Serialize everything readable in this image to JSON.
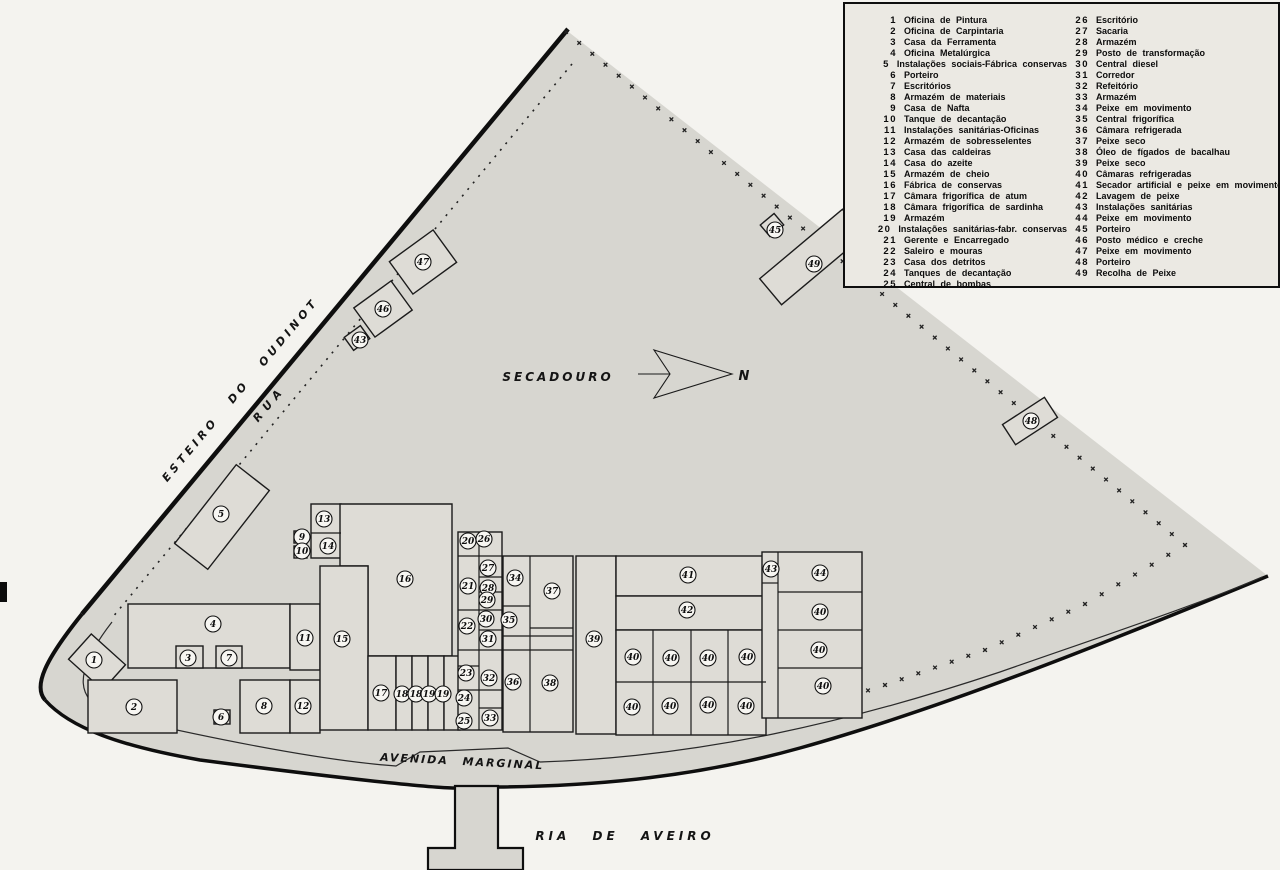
{
  "colors": {
    "paper": "#f4f3ef",
    "site_fill": "#d7d6d0",
    "building_fill": "#dedcd6",
    "ink": "#0e0e0e",
    "legend_bg": "#ebe9e3"
  },
  "map_labels": {
    "secadouro": "SECADOURO",
    "esteiro": "ESTEIRO DO OUDINOT",
    "rua": "RUA",
    "avenida": "AVENIDA MARGINAL",
    "ria": "RIA DE AVEIRO",
    "north": "N"
  },
  "legend": {
    "columns": [
      {
        "items": [
          {
            "num": "1",
            "label": "Oficina de Pintura"
          },
          {
            "num": "2",
            "label": "Oficina de Carpintaria"
          },
          {
            "num": "3",
            "label": "Casa da Ferramenta"
          },
          {
            "num": "4",
            "label": "Oficina Metalúrgica"
          },
          {
            "num": "5",
            "label": "Instalações sociais-Fábrica conservas"
          },
          {
            "num": "6",
            "label": "Porteiro"
          },
          {
            "num": "7",
            "label": "Escritórios"
          },
          {
            "num": "8",
            "label": "Armazém de materiais"
          },
          {
            "num": "9",
            "label": "Casa de Nafta"
          },
          {
            "num": "10",
            "label": "Tanque de decantação"
          },
          {
            "num": "11",
            "label": "Instalações sanitárias-Oficinas"
          },
          {
            "num": "12",
            "label": "Armazém de sobresselentes"
          },
          {
            "num": "13",
            "label": "Casa das caldeiras"
          },
          {
            "num": "14",
            "label": "Casa do azeite"
          },
          {
            "num": "15",
            "label": "Armazém de cheio"
          },
          {
            "num": "16",
            "label": "Fábrica de conservas"
          },
          {
            "num": "17",
            "label": "Câmara frigorífica de atum"
          },
          {
            "num": "18",
            "label": "Câmara frigorífica de sardinha"
          },
          {
            "num": "19",
            "label": "Armazém"
          },
          {
            "num": "20",
            "label": "Instalações sanitárias-fabr. conservas"
          },
          {
            "num": "21",
            "label": "Gerente e Encarregado"
          },
          {
            "num": "22",
            "label": "Saleiro e mouras"
          },
          {
            "num": "23",
            "label": "Casa dos detritos"
          },
          {
            "num": "24",
            "label": "Tanques de decantação"
          },
          {
            "num": "25",
            "label": "Central de bombas"
          }
        ]
      },
      {
        "items": [
          {
            "num": "26",
            "label": "Escritório"
          },
          {
            "num": "27",
            "label": "Sacaria"
          },
          {
            "num": "28",
            "label": "Armazém"
          },
          {
            "num": "29",
            "label": "Posto de transformação"
          },
          {
            "num": "30",
            "label": "Central diesel"
          },
          {
            "num": "31",
            "label": "Corredor"
          },
          {
            "num": "32",
            "label": "Refeitório"
          },
          {
            "num": "33",
            "label": "Armazém"
          },
          {
            "num": "34",
            "label": "Peixe em movimento"
          },
          {
            "num": "35",
            "label": "Central frigorífica"
          },
          {
            "num": "36",
            "label": "Câmara refrigerada"
          },
          {
            "num": "37",
            "label": "Peixe seco"
          },
          {
            "num": "38",
            "label": "Óleo de fígados de bacalhau"
          },
          {
            "num": "39",
            "label": "Peixe seco"
          },
          {
            "num": "40",
            "label": "Câmaras refrigeradas"
          },
          {
            "num": "41",
            "label": "Secador artificial e peixe em movimento"
          },
          {
            "num": "42",
            "label": "Lavagem de peixe"
          },
          {
            "num": "43",
            "label": "Instalações sanitárias"
          },
          {
            "num": "44",
            "label": "Peixe em movimento"
          },
          {
            "num": "45",
            "label": "Porteiro"
          },
          {
            "num": "46",
            "label": "Posto médico e creche"
          },
          {
            "num": "47",
            "label": "Peixe em movimento"
          },
          {
            "num": "48",
            "label": "Porteiro"
          },
          {
            "num": "49",
            "label": "Recolha de Peixe"
          }
        ]
      }
    ]
  },
  "map": {
    "buildings": [
      {
        "x": 222,
        "y": 517,
        "w": 100,
        "h": 42,
        "rot": -52
      },
      {
        "x": 423,
        "y": 262,
        "w": 54,
        "h": 40,
        "rot": -36
      },
      {
        "x": 383,
        "y": 309,
        "w": 46,
        "h": 36,
        "rot": -36
      },
      {
        "x": 357,
        "y": 338,
        "w": 20,
        "h": 16,
        "rot": -36
      },
      {
        "x": 772,
        "y": 225,
        "w": 18,
        "h": 15,
        "rot": -40
      },
      {
        "x": 812,
        "y": 257,
        "w": 108,
        "h": 34,
        "rot": -40
      },
      {
        "x": 1030,
        "y": 421,
        "w": 50,
        "h": 24,
        "rot": -33
      },
      {
        "x": 97,
        "y": 662,
        "w": 34,
        "h": 46,
        "rot": -48
      },
      {
        "x": 88,
        "y": 680,
        "w": 89,
        "h": 53
      },
      {
        "x": 128,
        "y": 604,
        "w": 162,
        "h": 64
      },
      {
        "x": 176,
        "y": 646,
        "w": 27,
        "h": 22
      },
      {
        "x": 216,
        "y": 646,
        "w": 26,
        "h": 22
      },
      {
        "x": 290,
        "y": 604,
        "w": 30,
        "h": 66
      },
      {
        "x": 240,
        "y": 680,
        "w": 50,
        "h": 53
      },
      {
        "x": 290,
        "y": 680,
        "w": 30,
        "h": 53
      },
      {
        "x": 214,
        "y": 710,
        "w": 16,
        "h": 14
      },
      {
        "x": 311,
        "y": 504,
        "w": 30,
        "h": 54
      },
      {
        "x": 294,
        "y": 531,
        "w": 13,
        "h": 12
      },
      {
        "x": 294,
        "y": 546,
        "w": 13,
        "h": 12
      },
      {
        "d": "M340,504 H452 V656 H368 V566 H340 Z"
      },
      {
        "x": 320,
        "y": 566,
        "w": 48,
        "h": 164
      },
      {
        "x": 368,
        "y": 656,
        "w": 28,
        "h": 74
      },
      {
        "x": 396,
        "y": 656,
        "w": 16,
        "h": 74
      },
      {
        "x": 412,
        "y": 656,
        "w": 16,
        "h": 74
      },
      {
        "x": 428,
        "y": 656,
        "w": 16,
        "h": 74
      },
      {
        "x": 444,
        "y": 656,
        "w": 16,
        "h": 74
      },
      {
        "x": 458,
        "y": 532,
        "w": 44,
        "h": 198
      },
      {
        "x": 503,
        "y": 556,
        "w": 70,
        "h": 176
      },
      {
        "x": 576,
        "y": 556,
        "w": 40,
        "h": 178
      },
      {
        "x": 616,
        "y": 556,
        "w": 150,
        "h": 40
      },
      {
        "x": 616,
        "y": 596,
        "w": 150,
        "h": 34
      },
      {
        "x": 616,
        "y": 630,
        "w": 150,
        "h": 105
      },
      {
        "x": 762,
        "y": 552,
        "w": 100,
        "h": 166
      }
    ],
    "walls": [
      [
        311,
        533,
        341,
        533
      ],
      [
        479,
        532,
        479,
        730
      ],
      [
        458,
        556,
        502,
        556
      ],
      [
        479,
        577,
        502,
        577
      ],
      [
        479,
        592,
        502,
        592
      ],
      [
        458,
        610,
        502,
        610
      ],
      [
        479,
        630,
        502,
        630
      ],
      [
        458,
        650,
        502,
        650
      ],
      [
        458,
        666,
        479,
        666
      ],
      [
        458,
        690,
        502,
        690
      ],
      [
        479,
        708,
        502,
        708
      ],
      [
        530,
        556,
        530,
        732
      ],
      [
        503,
        606,
        530,
        606
      ],
      [
        530,
        628,
        573,
        628
      ],
      [
        503,
        636,
        573,
        636
      ],
      [
        503,
        650,
        573,
        650
      ],
      [
        653,
        630,
        653,
        735
      ],
      [
        691,
        630,
        691,
        735
      ],
      [
        728,
        630,
        728,
        735
      ],
      [
        616,
        682,
        766,
        682
      ],
      [
        778,
        552,
        778,
        718
      ],
      [
        762,
        583,
        778,
        583
      ],
      [
        778,
        592,
        862,
        592
      ],
      [
        778,
        630,
        862,
        630
      ],
      [
        778,
        668,
        862,
        668
      ]
    ],
    "markers": [
      {
        "n": "1",
        "x": 94,
        "y": 660
      },
      {
        "n": "2",
        "x": 134,
        "y": 707
      },
      {
        "n": "3",
        "x": 188,
        "y": 658
      },
      {
        "n": "4",
        "x": 213,
        "y": 624
      },
      {
        "n": "5",
        "x": 221,
        "y": 514
      },
      {
        "n": "6",
        "x": 221,
        "y": 717
      },
      {
        "n": "7",
        "x": 229,
        "y": 658
      },
      {
        "n": "8",
        "x": 264,
        "y": 706
      },
      {
        "n": "9",
        "x": 302,
        "y": 537
      },
      {
        "n": "10",
        "x": 302,
        "y": 551
      },
      {
        "n": "11",
        "x": 305,
        "y": 638
      },
      {
        "n": "12",
        "x": 303,
        "y": 706
      },
      {
        "n": "13",
        "x": 324,
        "y": 519
      },
      {
        "n": "14",
        "x": 328,
        "y": 546
      },
      {
        "n": "15",
        "x": 342,
        "y": 639
      },
      {
        "n": "16",
        "x": 405,
        "y": 579
      },
      {
        "n": "17",
        "x": 381,
        "y": 693
      },
      {
        "n": "18",
        "x": 402,
        "y": 694
      },
      {
        "n": "18",
        "x": 416,
        "y": 694
      },
      {
        "n": "19",
        "x": 429,
        "y": 694
      },
      {
        "n": "19",
        "x": 443,
        "y": 694
      },
      {
        "n": "20",
        "x": 468,
        "y": 541
      },
      {
        "n": "21",
        "x": 468,
        "y": 586
      },
      {
        "n": "22",
        "x": 467,
        "y": 626
      },
      {
        "n": "23",
        "x": 466,
        "y": 673
      },
      {
        "n": "24",
        "x": 464,
        "y": 698
      },
      {
        "n": "25",
        "x": 464,
        "y": 721
      },
      {
        "n": "26",
        "x": 484,
        "y": 539
      },
      {
        "n": "27",
        "x": 488,
        "y": 568
      },
      {
        "n": "28",
        "x": 488,
        "y": 588
      },
      {
        "n": "29",
        "x": 487,
        "y": 600
      },
      {
        "n": "30",
        "x": 486,
        "y": 619
      },
      {
        "n": "31",
        "x": 488,
        "y": 639
      },
      {
        "n": "32",
        "x": 489,
        "y": 678
      },
      {
        "n": "33",
        "x": 490,
        "y": 718
      },
      {
        "n": "34",
        "x": 515,
        "y": 578
      },
      {
        "n": "35",
        "x": 509,
        "y": 620
      },
      {
        "n": "36",
        "x": 513,
        "y": 682
      },
      {
        "n": "37",
        "x": 552,
        "y": 591
      },
      {
        "n": "38",
        "x": 550,
        "y": 683
      },
      {
        "n": "39",
        "x": 594,
        "y": 639
      },
      {
        "n": "40",
        "x": 633,
        "y": 657
      },
      {
        "n": "40",
        "x": 671,
        "y": 658
      },
      {
        "n": "40",
        "x": 708,
        "y": 658
      },
      {
        "n": "40",
        "x": 747,
        "y": 657
      },
      {
        "n": "40",
        "x": 632,
        "y": 707
      },
      {
        "n": "40",
        "x": 670,
        "y": 706
      },
      {
        "n": "40",
        "x": 708,
        "y": 705
      },
      {
        "n": "40",
        "x": 746,
        "y": 706
      },
      {
        "n": "41",
        "x": 688,
        "y": 575
      },
      {
        "n": "42",
        "x": 687,
        "y": 610
      },
      {
        "n": "43",
        "x": 771,
        "y": 569
      },
      {
        "n": "44",
        "x": 820,
        "y": 573
      },
      {
        "n": "40",
        "x": 820,
        "y": 612
      },
      {
        "n": "40",
        "x": 819,
        "y": 650
      },
      {
        "n": "40",
        "x": 823,
        "y": 686
      },
      {
        "n": "43",
        "x": 360,
        "y": 340
      },
      {
        "n": "45",
        "x": 775,
        "y": 230
      },
      {
        "n": "46",
        "x": 383,
        "y": 309
      },
      {
        "n": "47",
        "x": 423,
        "y": 262
      },
      {
        "n": "48",
        "x": 1031,
        "y": 421
      },
      {
        "n": "49",
        "x": 814,
        "y": 264
      }
    ]
  }
}
